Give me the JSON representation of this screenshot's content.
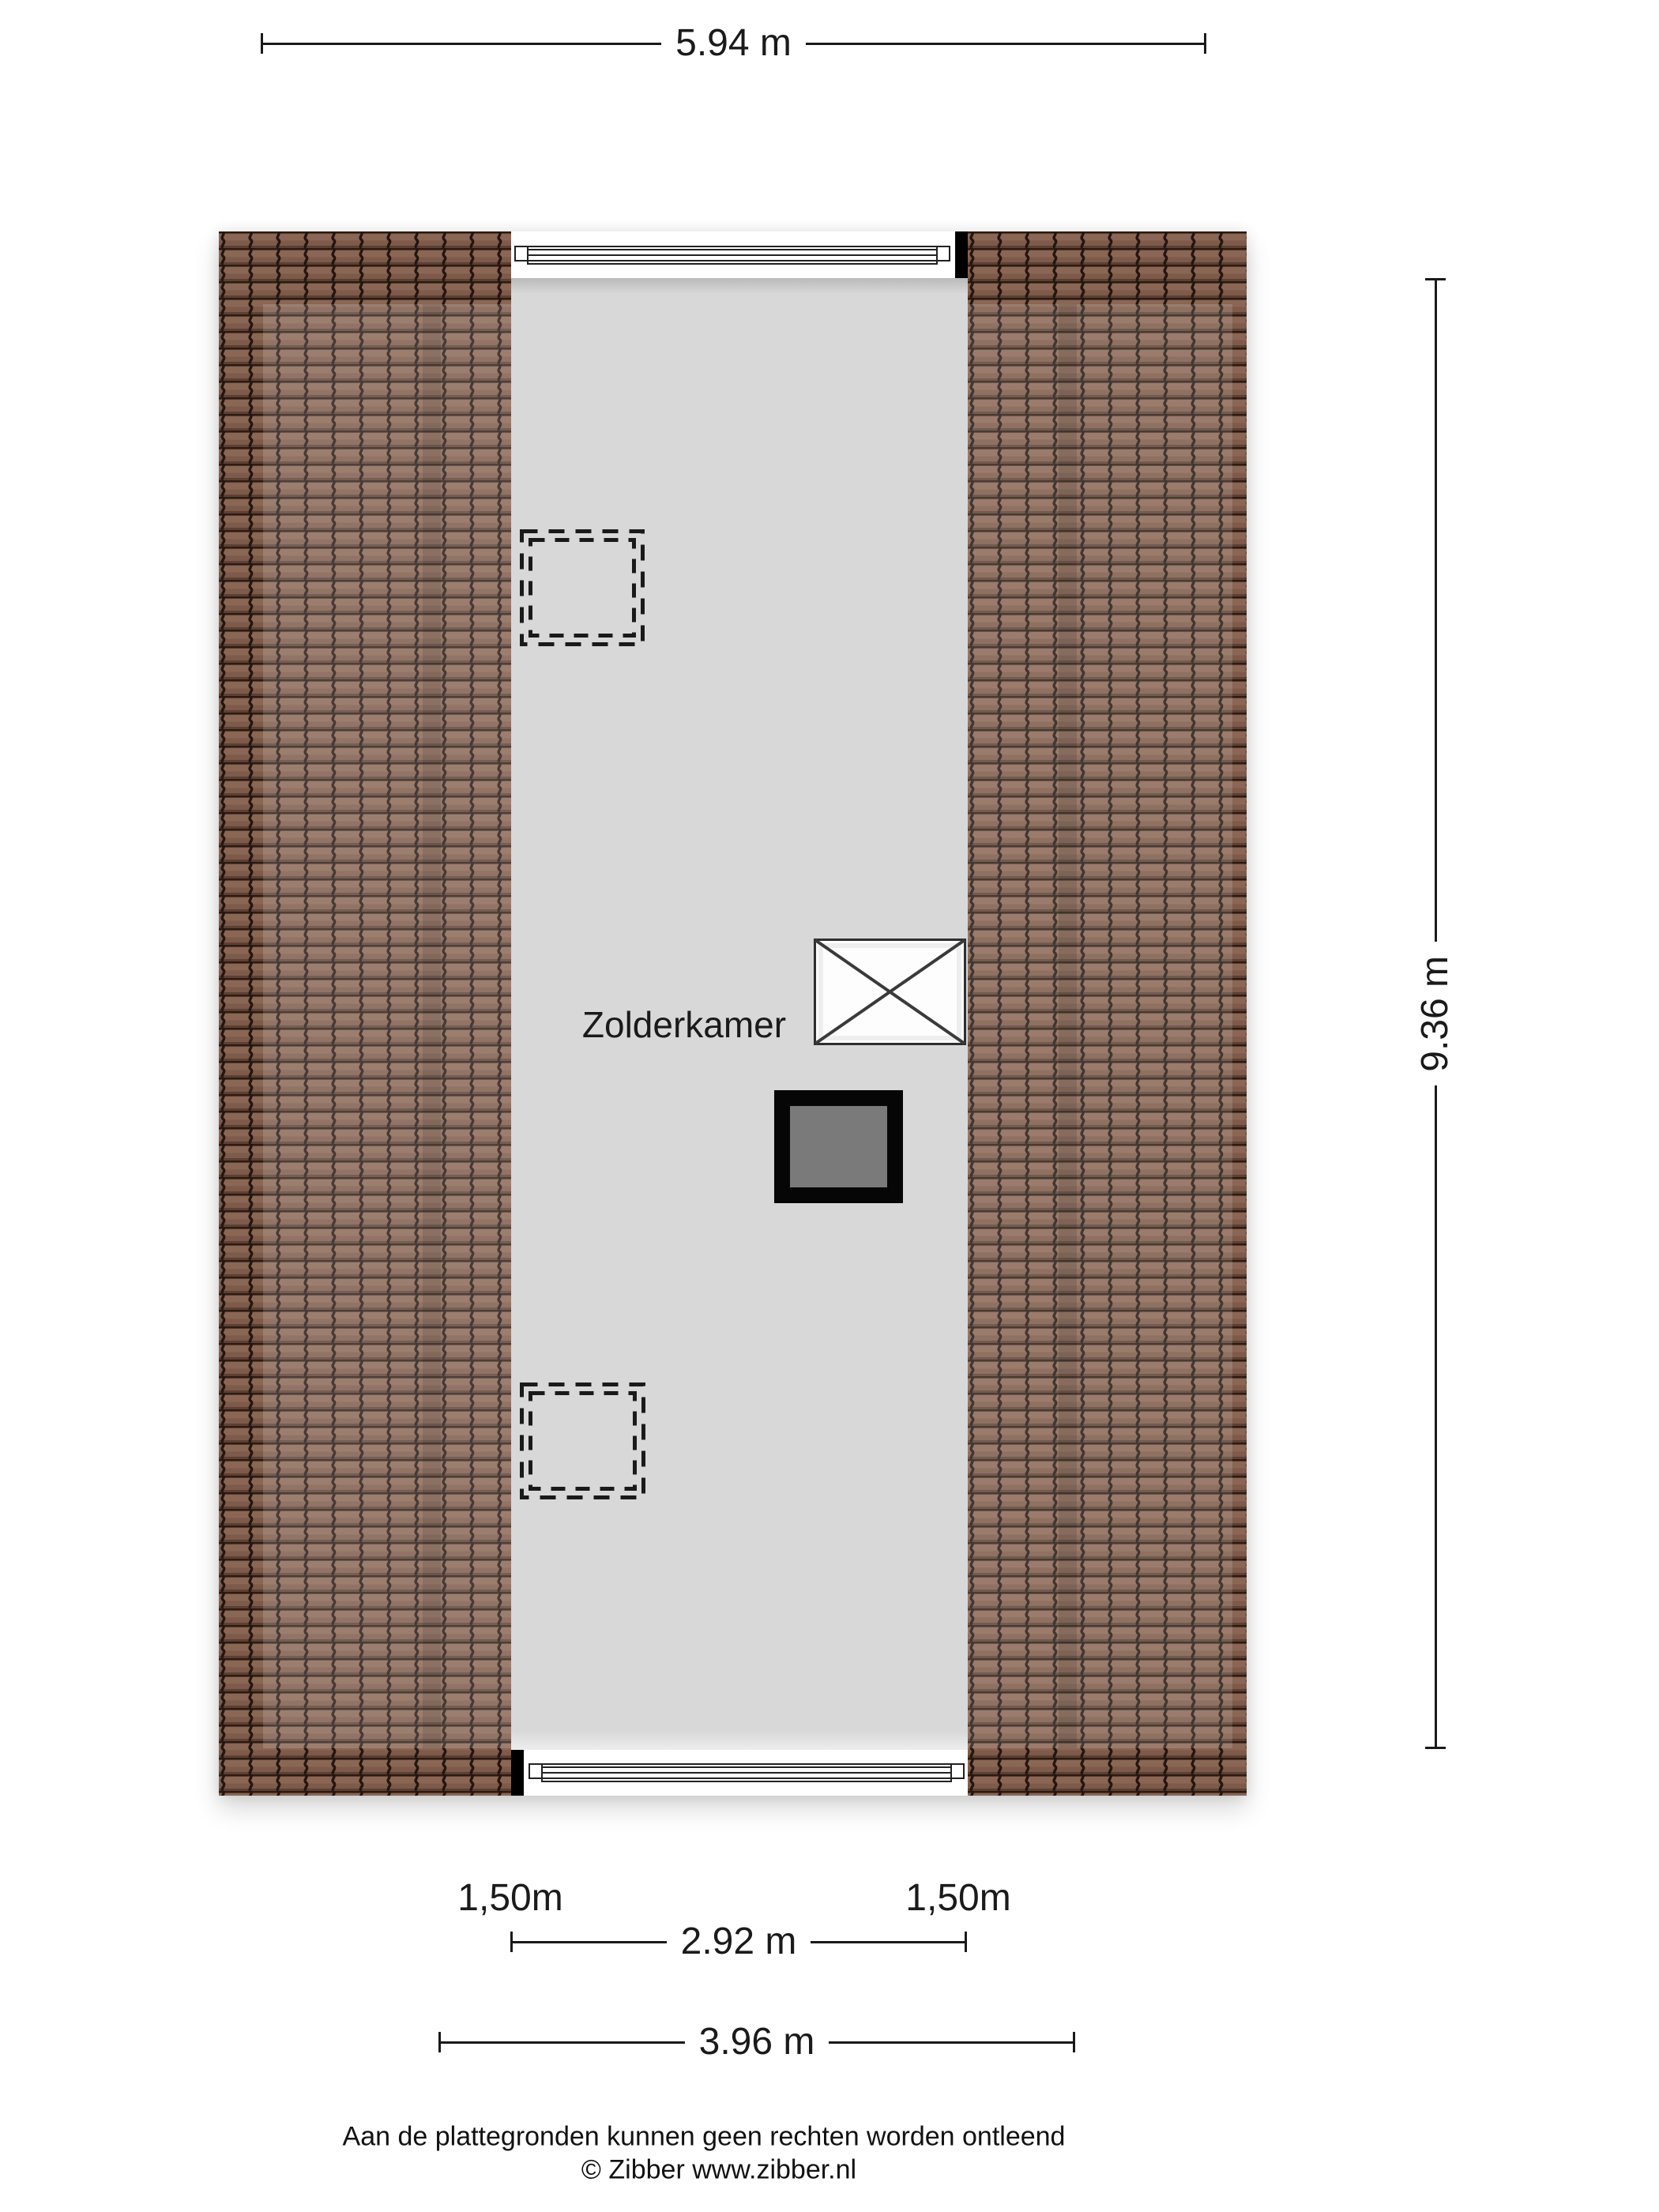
{
  "dims": {
    "width_total": "5.94 m",
    "height_total": "9.36 m",
    "width_inner": "2.92 m",
    "width_outer": "3.96 m",
    "headroom_left": "1,50m",
    "headroom_right": "1,50m"
  },
  "room": {
    "label": "Zolderkamer"
  },
  "footer": {
    "disclaimer": "Aan de plattegronden kunnen geen rechten worden ontleend",
    "credit": "© Zibber www.zibber.nl"
  },
  "colors": {
    "tile": "#7d5a49",
    "tile_gap": "#241510",
    "floor": "#d8d8d8",
    "ink": "#1a1a1a",
    "chimney_fill": "#7a7a7a"
  }
}
